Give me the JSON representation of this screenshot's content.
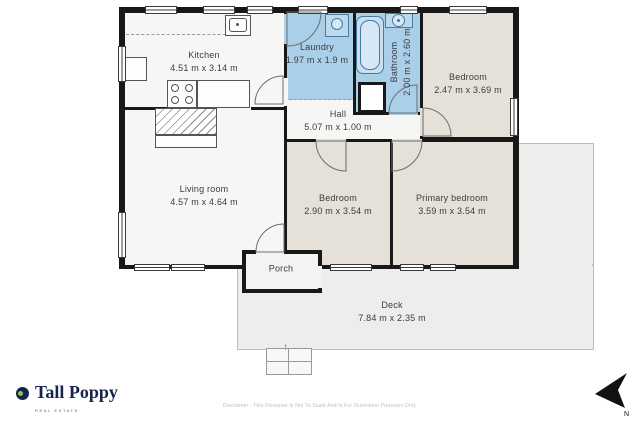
{
  "floorplan": {
    "rooms": {
      "kitchen": {
        "name": "Kitchen",
        "dims": "4.51 m x 3.14 m"
      },
      "laundry": {
        "name": "Laundry",
        "dims": "1.97 m x 1.9 m"
      },
      "bathroom": {
        "name": "Bathroom",
        "dims": "2.00 m x 2.60 m"
      },
      "bedroom_top": {
        "name": "Bedroom",
        "dims": "2.47 m x 3.69 m"
      },
      "hall": {
        "name": "Hall",
        "dims": "5.07 m x 1.00 m"
      },
      "living_room": {
        "name": "Living room",
        "dims": "4.57 m x 4.64 m"
      },
      "bedroom_mid": {
        "name": "Bedroom",
        "dims": "2.90 m x 3.54 m"
      },
      "primary_bedroom": {
        "name": "Primary bedroom",
        "dims": "3.59 m x 3.54 m"
      },
      "porch": {
        "name": "Porch"
      },
      "deck": {
        "name": "Deck",
        "dims": "7.84 m x 2.35 m"
      }
    },
    "compass": {
      "label": "N"
    },
    "colors": {
      "wall": "#181818",
      "dry_room_fill": "#f6f6f4",
      "wet_room_fill": "#a9cfe9",
      "bedroom_fill": "#e6e1d8",
      "deck_fill": "#ededeb",
      "porch_fill": "#f3f3f1",
      "fixture_line": "#4a7a9e"
    }
  },
  "branding": {
    "logo_text": "Tall Poppy",
    "logo_subtext": "REAL ESTATE",
    "logo_color": "#15234e",
    "logo_dot_color": "#8ec63f"
  },
  "footer": {
    "disclaimer": "Disclaimer - This Floorplan Is Not To Scale And Is For Illustration Purposes Only"
  }
}
